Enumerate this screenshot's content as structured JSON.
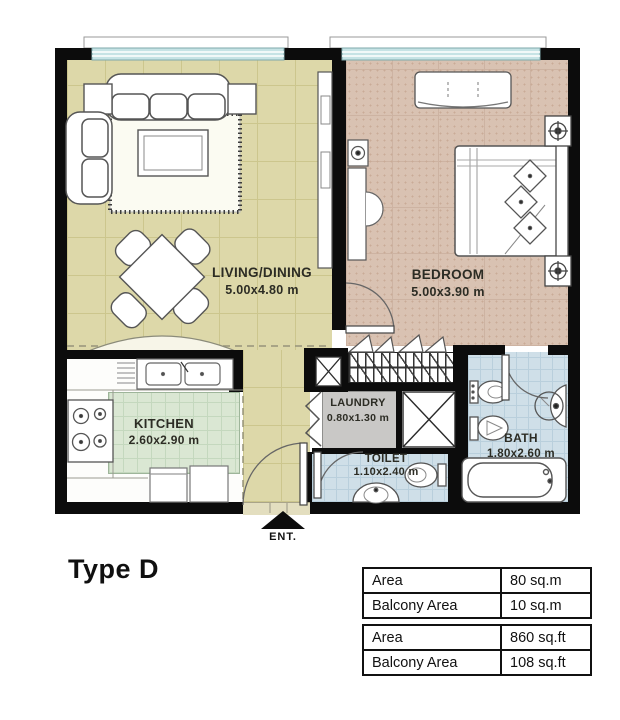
{
  "plan": {
    "title": "Type D",
    "entrance": {
      "label": "ENT."
    },
    "rooms": {
      "living": {
        "name": "LIVING/DINING",
        "dims": "5.00x4.80 m"
      },
      "bedroom": {
        "name": "BEDROOM",
        "dims": "5.00x3.90 m"
      },
      "kitchen": {
        "name": "KITCHEN",
        "dims": "2.60x2.90 m"
      },
      "laundry": {
        "name": "LAUNDRY",
        "dims": "0.80x1.30 m"
      },
      "toilet": {
        "name": "TOILET",
        "dims": "1.10x2.40 m"
      },
      "bath": {
        "name": "BATH",
        "dims": "1.80x2.60 m"
      }
    },
    "area_tables": [
      {
        "rows": [
          {
            "label": "Area",
            "value": "80 sq.m"
          },
          {
            "label": "Balcony Area",
            "value": "10 sq.m"
          }
        ]
      },
      {
        "rows": [
          {
            "label": "Area",
            "value": "860 sq.ft"
          },
          {
            "label": "Balcony Area",
            "value": "108 sq.ft"
          }
        ]
      }
    ],
    "colors": {
      "wall": "#0c0c0c",
      "living_floor": "#ddd8a9",
      "bedroom_floor": "#d9c2b2",
      "kitchen_floor": "#dae7d3",
      "wet_floor": "#cfdfe8",
      "laundry_floor": "#c9c8c6",
      "window": "#c6e3e5"
    }
  }
}
